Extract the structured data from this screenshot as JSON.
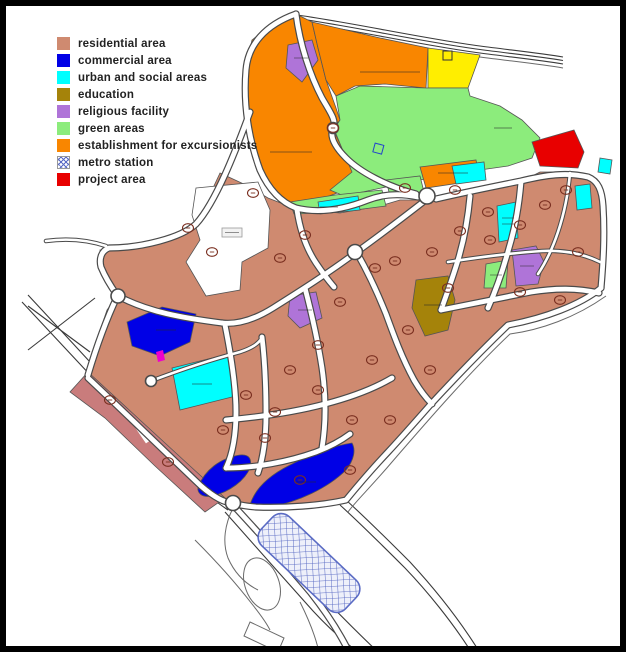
{
  "title": "land use zoning map",
  "legend": {
    "items": [
      {
        "key": "residential",
        "label": "residential area",
        "type": "solid"
      },
      {
        "key": "commercial",
        "label": "commercial area",
        "type": "solid"
      },
      {
        "key": "urban_social",
        "label": "urban and social areas",
        "type": "solid"
      },
      {
        "key": "education",
        "label": "education",
        "type": "solid"
      },
      {
        "key": "religious",
        "label": "religious facility",
        "type": "solid"
      },
      {
        "key": "green",
        "label": "green areas",
        "type": "solid"
      },
      {
        "key": "excursionists",
        "label": "establishment for excursionists",
        "type": "solid"
      },
      {
        "key": "metro",
        "label": "metro station",
        "type": "hatch"
      },
      {
        "key": "project",
        "label": "project area",
        "type": "solid"
      }
    ]
  },
  "map": {
    "colors": {
      "residential": "#CF8A70",
      "residential_rose": "#C97C7C",
      "commercial": "#0000E6",
      "urban_social": "#00FFFF",
      "education": "#A5830A",
      "religious": "#AF74D8",
      "green": "#8CEC7C",
      "excursionists": "#F98600",
      "project": "#E80000",
      "yellow_zone": "#FFEE00",
      "metro": "#EEF0FA",
      "metro_line": "#5A6BC4",
      "road_casing": "#4A4A4A",
      "marker": "#7A2F20",
      "magenta": "#EE00CC"
    },
    "markers": [
      [
        188,
        228
      ],
      [
        253,
        193
      ],
      [
        305,
        235
      ],
      [
        212,
        252
      ],
      [
        280,
        258
      ],
      [
        375,
        268
      ],
      [
        395,
        261
      ],
      [
        432,
        252
      ],
      [
        460,
        231
      ],
      [
        488,
        212
      ],
      [
        520,
        225
      ],
      [
        545,
        205
      ],
      [
        566,
        190
      ],
      [
        578,
        252
      ],
      [
        560,
        300
      ],
      [
        520,
        292
      ],
      [
        490,
        240
      ],
      [
        448,
        288
      ],
      [
        430,
        370
      ],
      [
        408,
        330
      ],
      [
        390,
        420
      ],
      [
        352,
        420
      ],
      [
        340,
        302
      ],
      [
        318,
        390
      ],
      [
        300,
        480
      ],
      [
        275,
        412
      ],
      [
        246,
        395
      ],
      [
        223,
        430
      ],
      [
        168,
        462
      ],
      [
        110,
        400
      ],
      [
        290,
        370
      ],
      [
        318,
        345
      ],
      [
        372,
        360
      ],
      [
        350,
        470
      ],
      [
        265,
        438
      ],
      [
        455,
        190
      ],
      [
        405,
        188
      ],
      [
        333,
        128
      ]
    ]
  }
}
